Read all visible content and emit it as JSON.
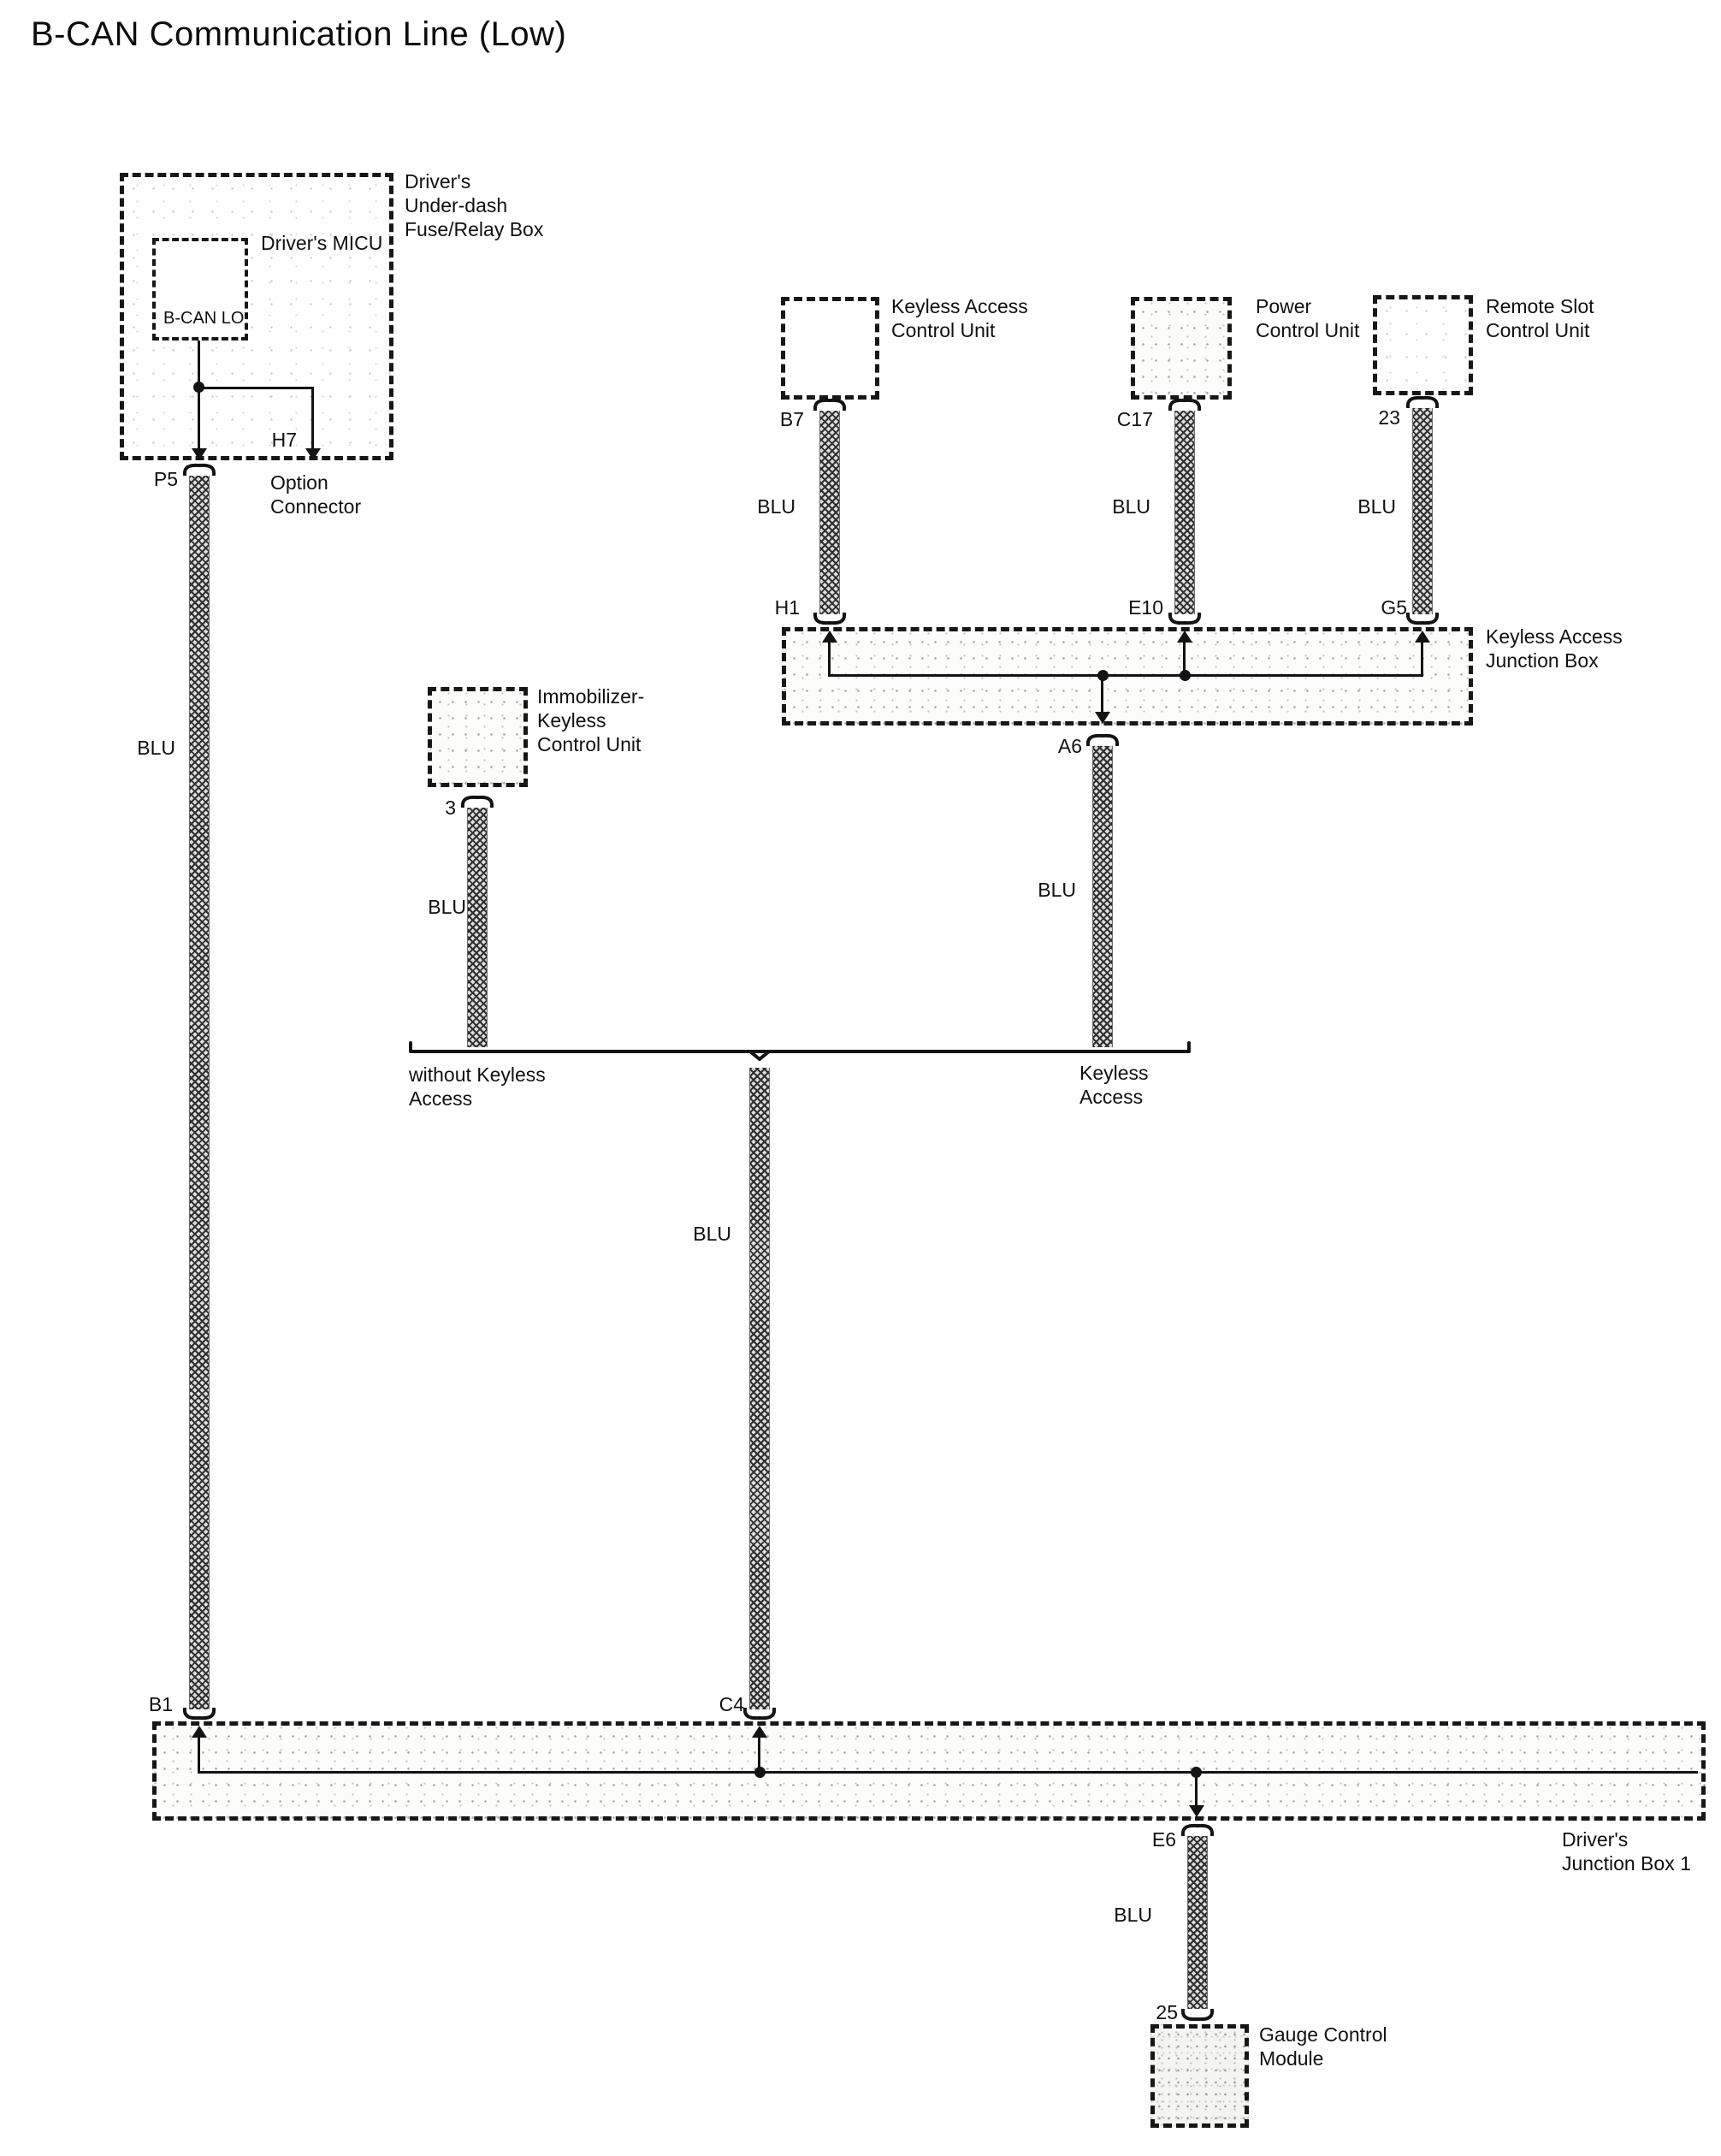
{
  "title": "B-CAN Communication Line (Low)",
  "colors": {
    "line": "#131313",
    "wire_hatch": "#2f2f2f",
    "wire_base": "#dcdcdc",
    "box_border": "#171717",
    "background": "#ffffff"
  },
  "components": {
    "fuse_box": {
      "label": "Driver's\nUnder-dash\nFuse/Relay Box",
      "micu_label": "Driver's MICU",
      "bcan_lo_label": "B-CAN LO",
      "pin_p5": "P5",
      "pin_h7": "H7",
      "option_connector_label": "Option\nConnector",
      "wire_label": "BLU"
    },
    "keyless_access_cu": {
      "label": "Keyless Access\nControl Unit",
      "pin_b7": "B7",
      "wire_label": "BLU"
    },
    "power_cu": {
      "label": "Power\nControl Unit",
      "pin_c17": "C17",
      "wire_label": "BLU"
    },
    "remote_slot_cu": {
      "label": "Remote Slot\nControl Unit",
      "pin_23": "23",
      "wire_label": "BLU"
    },
    "keyless_junction_box": {
      "label": "Keyless Access\nJunction Box",
      "pin_h1": "H1",
      "pin_e10": "E10",
      "pin_g5": "G5",
      "pin_a6": "A6",
      "wire_label": "BLU"
    },
    "immobilizer_cu": {
      "label": "Immobilizer-\nKeyless\nControl Unit",
      "pin_3": "3",
      "wire_label": "BLU"
    },
    "branch": {
      "without_keyless_label": "without Keyless\nAccess",
      "keyless_label": "Keyless\nAccess",
      "wire_label": "BLU"
    },
    "junction_box_1": {
      "label": "Driver's\nJunction Box 1",
      "pin_b1": "B1",
      "pin_c4": "C4",
      "pin_e6": "E6",
      "wire_label": "BLU"
    },
    "gauge_module": {
      "label": "Gauge Control\nModule",
      "pin_25": "25"
    }
  }
}
